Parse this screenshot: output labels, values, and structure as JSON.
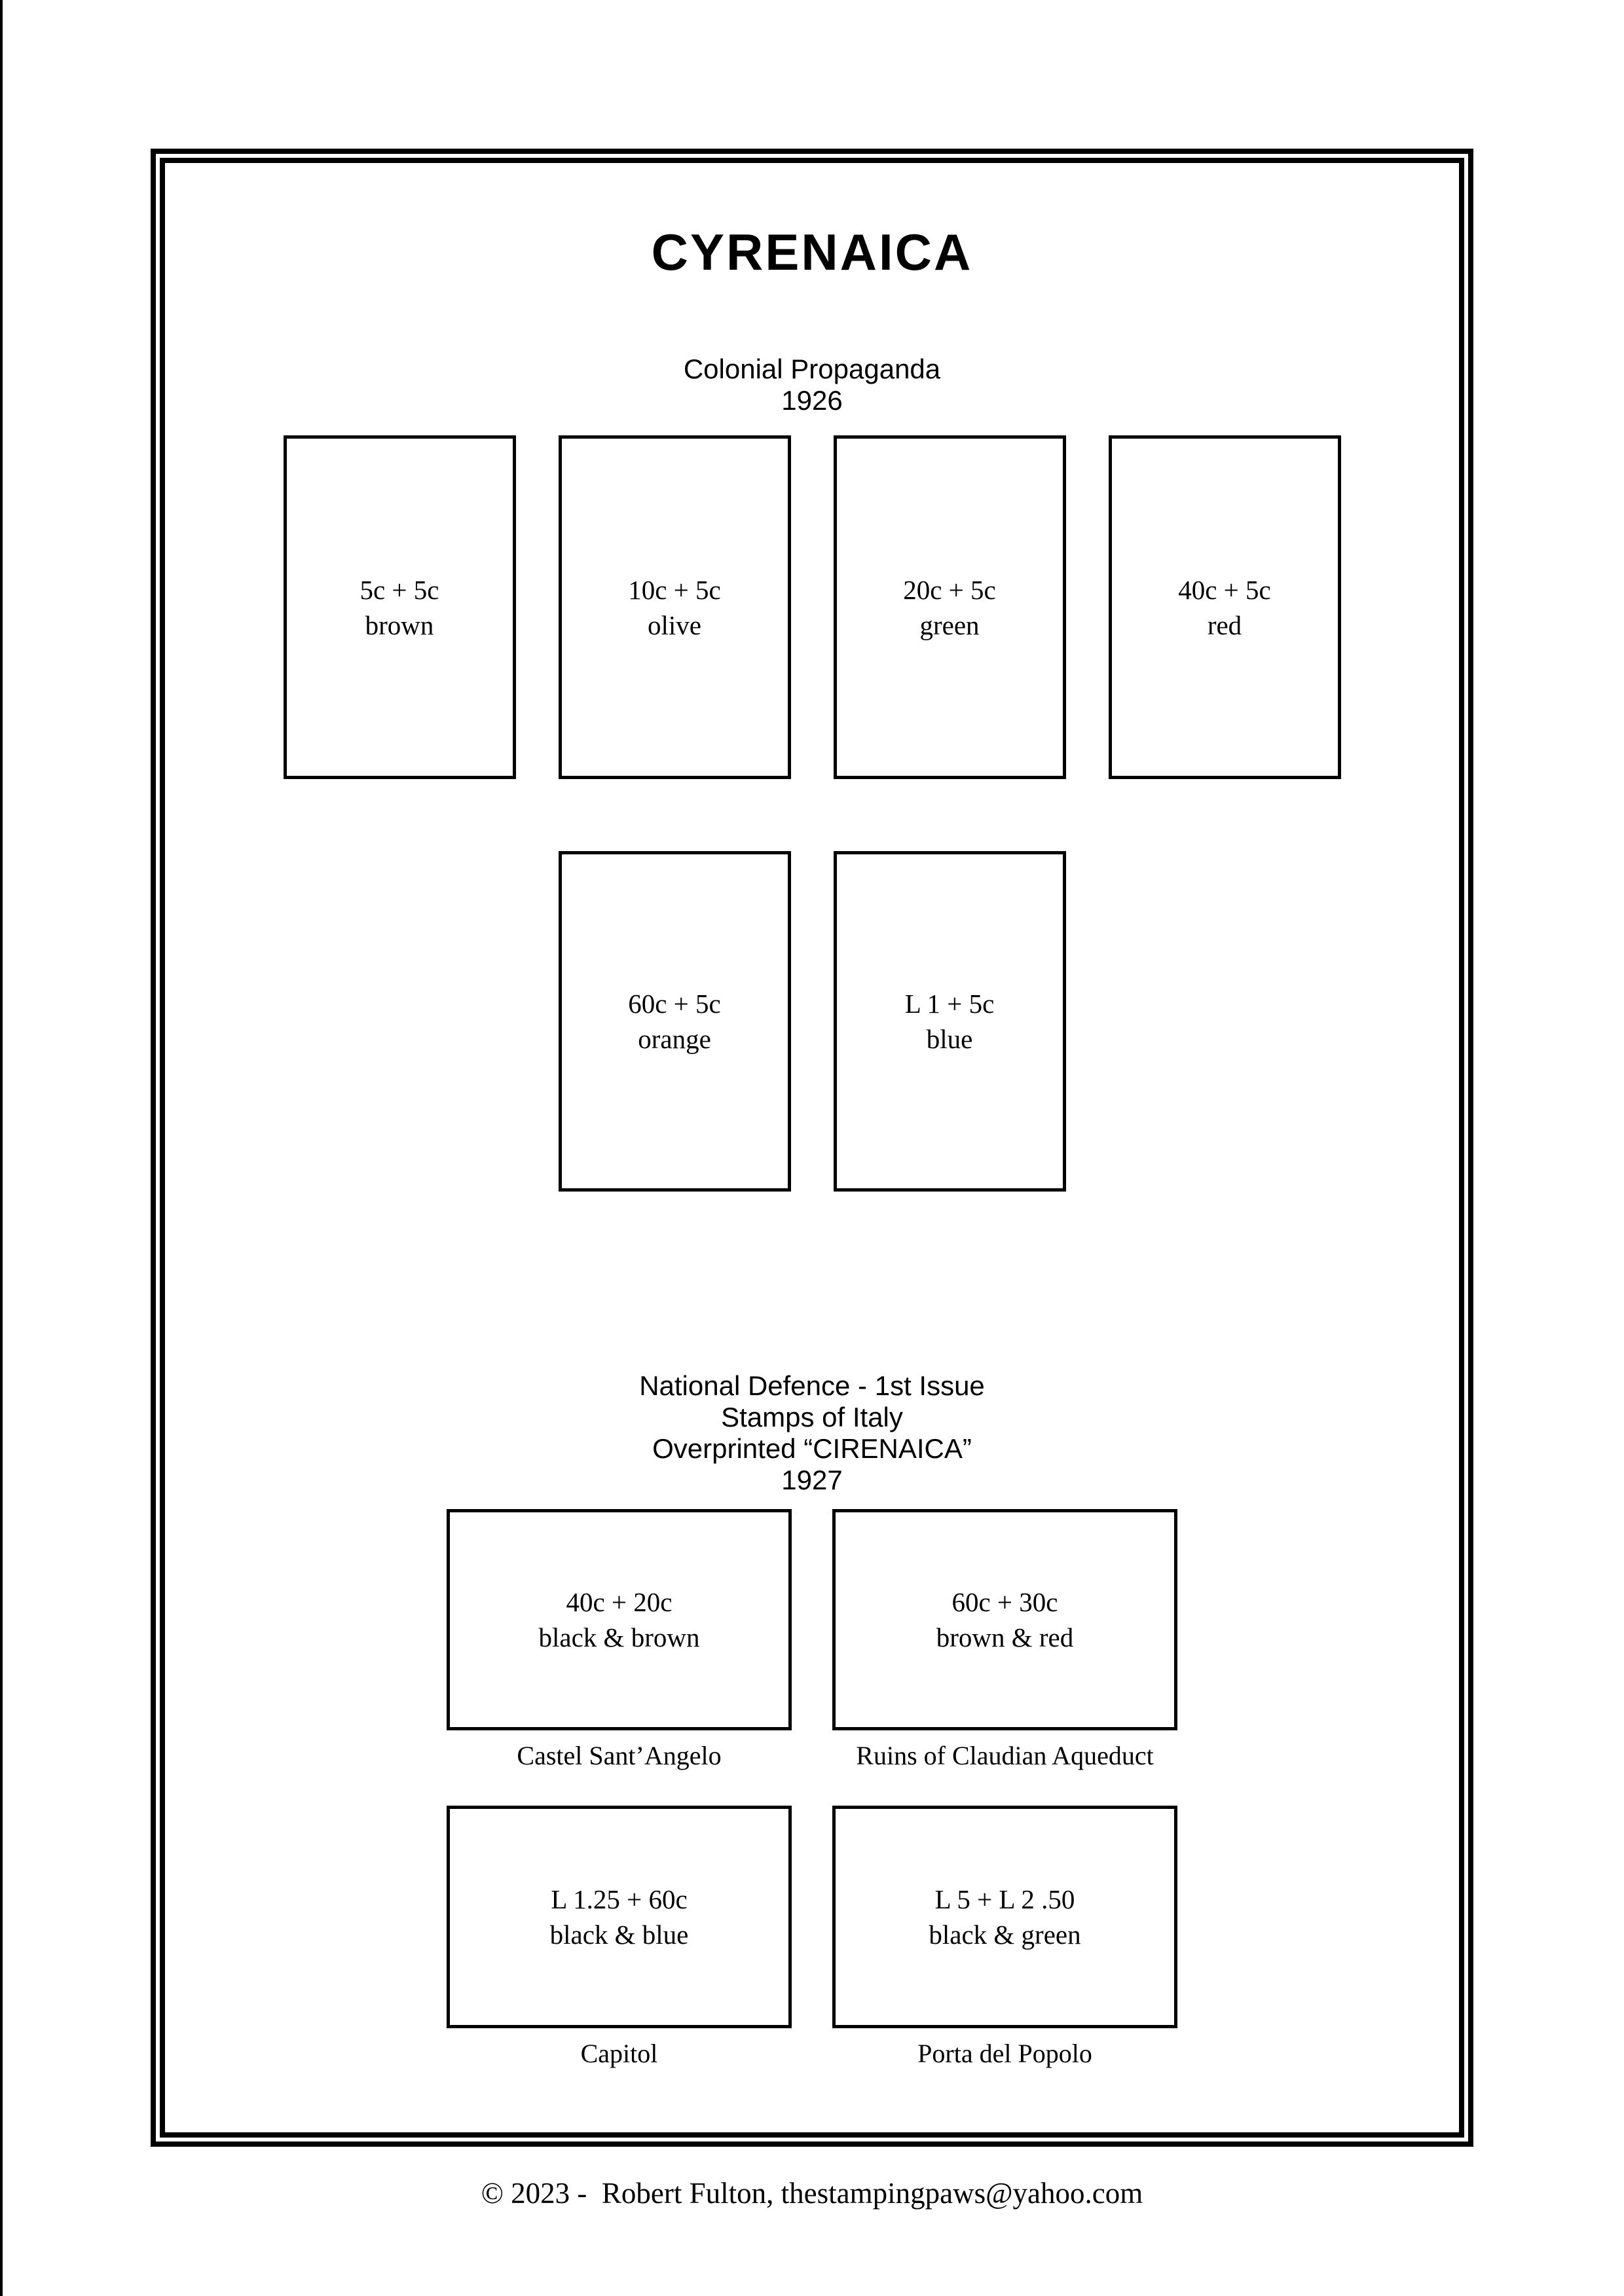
{
  "page": {
    "title": "CYRENAICA",
    "footer": "© 2023 -  Robert Fulton, thestampingpaws@yahoo.com"
  },
  "colors": {
    "ink": "#000000",
    "paper": "#ffffff"
  },
  "sections": [
    {
      "heading_lines": [
        "Colonial Propaganda",
        "1926"
      ],
      "rows": [
        {
          "stamps": [
            {
              "denomination": "5c + 5c",
              "color": "brown"
            },
            {
              "denomination": "10c + 5c",
              "color": "olive"
            },
            {
              "denomination": "20c + 5c",
              "color": "green"
            },
            {
              "denomination": "40c + 5c",
              "color": "red"
            }
          ]
        },
        {
          "stamps": [
            {
              "denomination": "60c + 5c",
              "color": "orange"
            },
            {
              "denomination": "L 1 + 5c",
              "color": "blue"
            }
          ]
        }
      ]
    },
    {
      "heading_lines": [
        "National Defence - 1st Issue",
        "Stamps of Italy",
        "Overprinted “CIRENAICA”",
        "1927"
      ],
      "rows": [
        {
          "stamps": [
            {
              "denomination": "40c + 20c",
              "color": "black & brown",
              "caption": "Castel Sant’Angelo"
            },
            {
              "denomination": "60c + 30c",
              "color": "brown & red",
              "caption": "Ruins of Claudian Aqueduct"
            }
          ]
        },
        {
          "stamps": [
            {
              "denomination": "L 1.25 + 60c",
              "color": "black & blue",
              "caption": "Capitol"
            },
            {
              "denomination": "L 5 + L 2 .50",
              "color": "black & green",
              "caption": "Porta del Popolo"
            }
          ]
        }
      ]
    }
  ]
}
